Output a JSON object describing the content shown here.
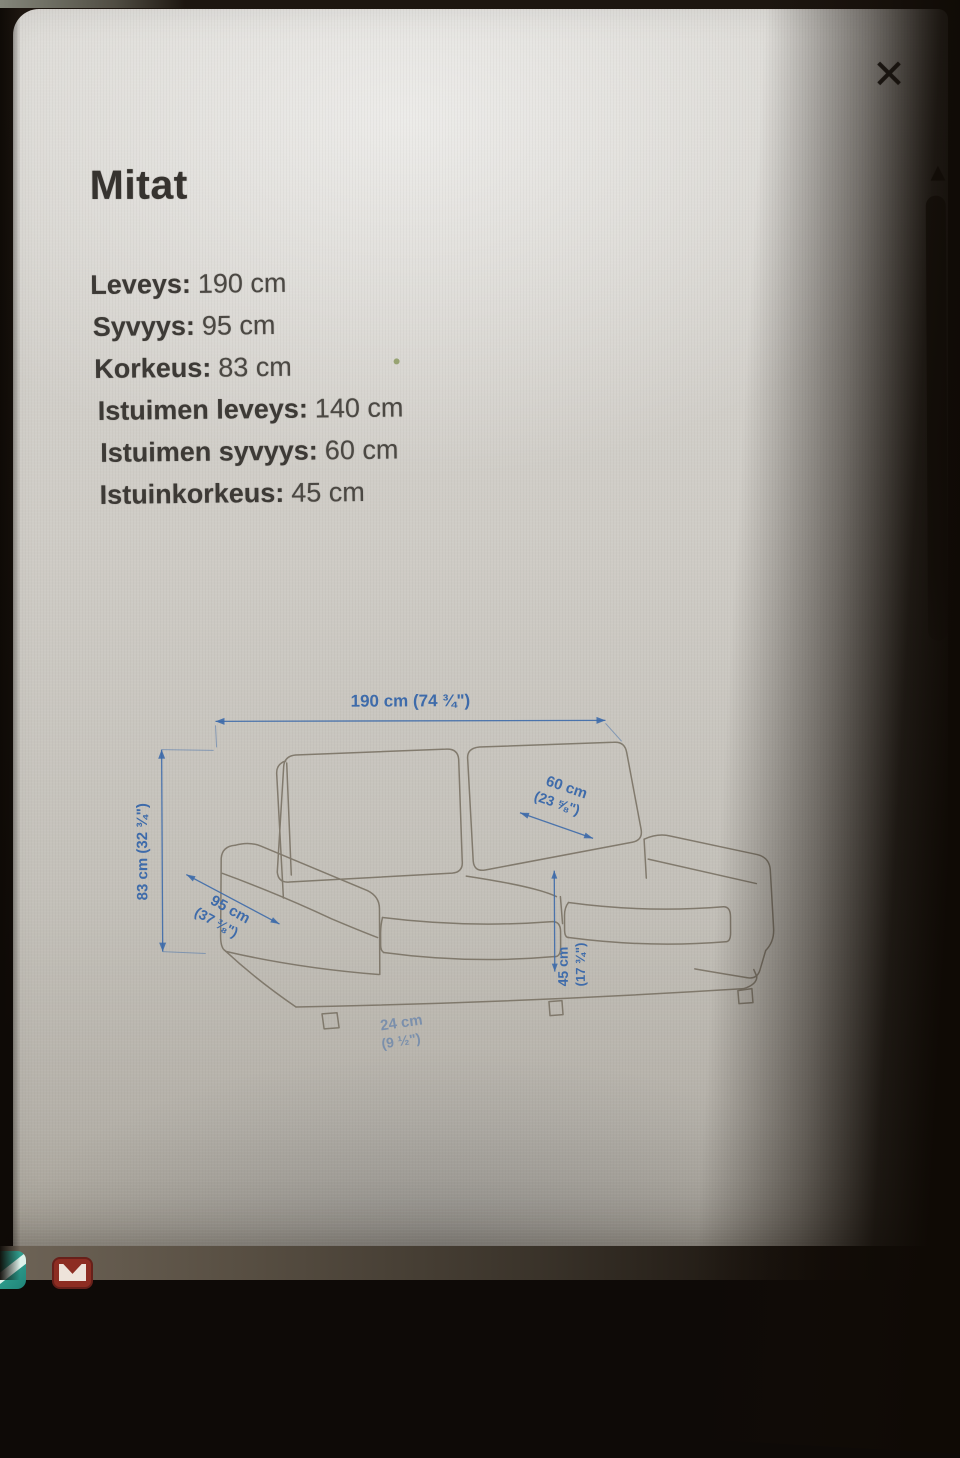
{
  "panel": {
    "title": "Mitat",
    "close_icon": "✕",
    "dimensions": [
      {
        "label": "Leveys:",
        "value": "190 cm"
      },
      {
        "label": "Syvyys:",
        "value": "95 cm"
      },
      {
        "label": "Korkeus:",
        "value": "83 cm"
      },
      {
        "label": "Istuimen leveys:",
        "value": "140 cm"
      },
      {
        "label": "Istuimen syvyys:",
        "value": "60 cm"
      },
      {
        "label": "Istuinkorkeus:",
        "value": "45 cm"
      }
    ]
  },
  "diagram": {
    "width_label": "190 cm (74 ¾\")",
    "height_label": "83 cm (32 ¾\")",
    "depth_label_1": "95 cm",
    "depth_label_2": "(37 ⅜\")",
    "seat_depth_label_1": "60 cm",
    "seat_depth_label_2": "(23 ⅝\")",
    "seat_height_label_1": "45 cm",
    "seat_height_label_2": "(17 ¾\")",
    "armrest_label_1": "24 cm",
    "armrest_label_2": "(9 ½\")",
    "colors": {
      "dimension_blue": "#3e6baa",
      "sketch_stroke": "#766e60"
    }
  },
  "scrollbar": {
    "up_arrow_icon": "▲"
  }
}
